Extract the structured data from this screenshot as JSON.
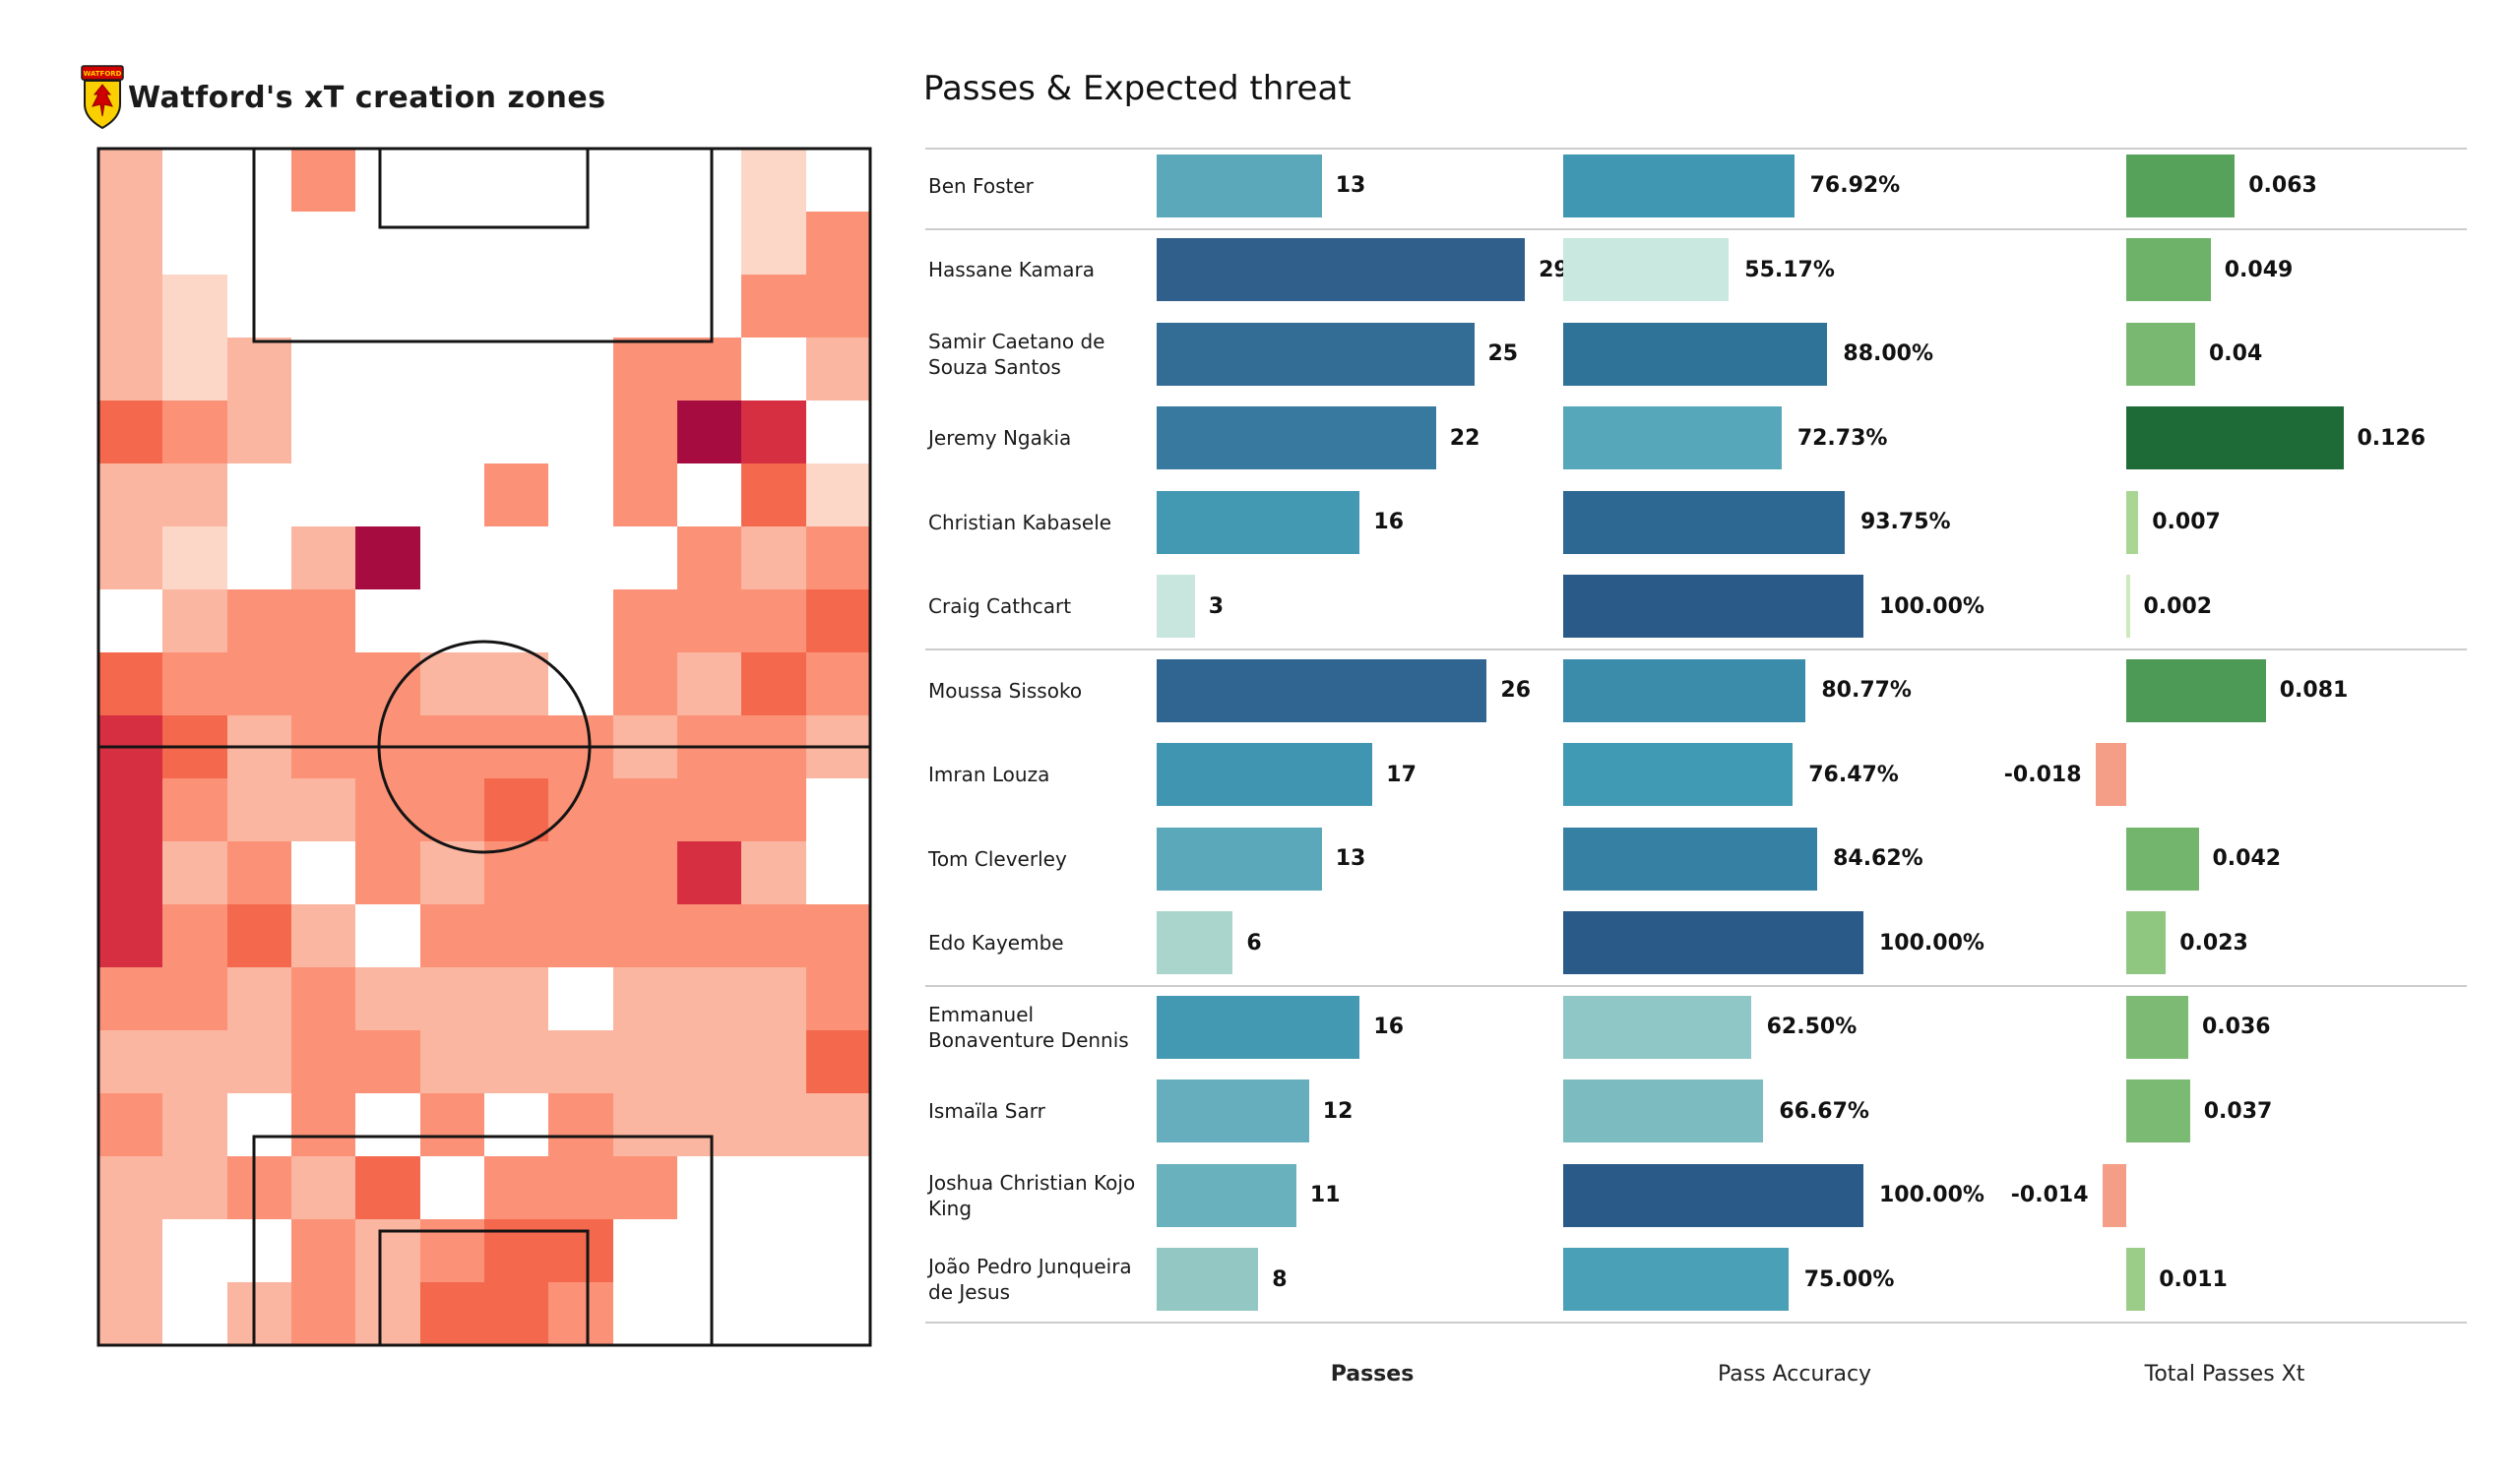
{
  "pitch_panel": {
    "title": "Watford's xT creation zones",
    "club": "Watford",
    "crest_colors": {
      "shield": "#fbd000",
      "band": "#d10000",
      "outline": "#1a1a1a"
    },
    "heatmap_palette": {
      "0": "transparent",
      "1": "#fcd7c8",
      "2": "#fbb6a1",
      "3": "#fb9277",
      "4": "#f4694d",
      "5": "#d62f42",
      "6": "#a60c3f"
    }
  },
  "chart_panel": {
    "title": "Passes & Expected threat",
    "footer": {
      "passes": "Passes",
      "accuracy": "Pass Accuracy",
      "xt": "Total Passes Xt"
    },
    "negative_color": "#f49d87",
    "group_separators_after": [
      0,
      5,
      9,
      13
    ],
    "players": [
      {
        "name": "Ben Foster",
        "passes": 13,
        "accuracy_value": 76.92,
        "accuracy_label": "76.92%",
        "xt": 0.063,
        "xt_label": "0.063",
        "passes_color": "#5ca8bb",
        "accuracy_color": "#4097b2",
        "xt_color": "#57a25b"
      },
      {
        "name": "Hassane Kamara",
        "passes": 29,
        "accuracy_value": 55.17,
        "accuracy_label": "55.17%",
        "xt": 0.049,
        "xt_label": "0.049",
        "passes_color": "#2f5f8a",
        "accuracy_color": "#c9e8e0",
        "xt_color": "#6db268"
      },
      {
        "name": "Samir Caetano de Souza Santos",
        "passes": 25,
        "accuracy_value": 88.0,
        "accuracy_label": "88.00%",
        "xt": 0.04,
        "xt_label": "0.04",
        "passes_color": "#336d96",
        "accuracy_color": "#2f7399",
        "xt_color": "#79b871"
      },
      {
        "name": "Jeremy Ngakia",
        "passes": 22,
        "accuracy_value": 72.73,
        "accuracy_label": "72.73%",
        "xt": 0.126,
        "xt_label": "0.126",
        "passes_color": "#37799f",
        "accuracy_color": "#56a7ba",
        "xt_color": "#1e6b38"
      },
      {
        "name": "Christian Kabasele",
        "passes": 16,
        "accuracy_value": 93.75,
        "accuracy_label": "93.75%",
        "xt": 0.007,
        "xt_label": "0.007",
        "passes_color": "#4398b2",
        "accuracy_color": "#2c6891",
        "xt_color": "#a9d693"
      },
      {
        "name": "Craig Cathcart",
        "passes": 3,
        "accuracy_value": 100.0,
        "accuracy_label": "100.00%",
        "xt": 0.002,
        "xt_label": "0.002",
        "passes_color": "#c8e6de",
        "accuracy_color": "#2a5a88",
        "xt_color": "#cde9bd"
      },
      {
        "name": "Moussa Sissoko",
        "passes": 26,
        "accuracy_value": 80.77,
        "accuracy_label": "80.77%",
        "xt": 0.081,
        "xt_label": "0.081",
        "passes_color": "#2f6590",
        "accuracy_color": "#3b8cab",
        "xt_color": "#4c9a55"
      },
      {
        "name": "Imran Louza",
        "passes": 17,
        "accuracy_value": 76.47,
        "accuracy_label": "76.47%",
        "xt": -0.018,
        "xt_label": "-0.018",
        "passes_color": "#4095b0",
        "accuracy_color": "#419ab4",
        "xt_color": "#f49d87"
      },
      {
        "name": "Tom Cleverley",
        "passes": 13,
        "accuracy_value": 84.62,
        "accuracy_label": "84.62%",
        "xt": 0.042,
        "xt_label": "0.042",
        "passes_color": "#5ca8bb",
        "accuracy_color": "#3681a3",
        "xt_color": "#73b56d"
      },
      {
        "name": "Edo Kayembe",
        "passes": 6,
        "accuracy_value": 100.0,
        "accuracy_label": "100.00%",
        "xt": 0.023,
        "xt_label": "0.023",
        "passes_color": "#a9d5cd",
        "accuracy_color": "#2a5a88",
        "xt_color": "#8fc680"
      },
      {
        "name": "Emmanuel Bonaventure Dennis",
        "passes": 16,
        "accuracy_value": 62.5,
        "accuracy_label": "62.50%",
        "xt": 0.036,
        "xt_label": "0.036",
        "passes_color": "#4398b2",
        "accuracy_color": "#8fc7c6",
        "xt_color": "#7dbb74"
      },
      {
        "name": "Ismaïla Sarr",
        "passes": 12,
        "accuracy_value": 66.67,
        "accuracy_label": "66.67%",
        "xt": 0.037,
        "xt_label": "0.037",
        "passes_color": "#66aebd",
        "accuracy_color": "#7cbcc1",
        "xt_color": "#7bba73"
      },
      {
        "name": "Joshua Christian Kojo King",
        "passes": 11,
        "accuracy_value": 100.0,
        "accuracy_label": "100.00%",
        "xt": -0.014,
        "xt_label": "-0.014",
        "passes_color": "#6ab1be",
        "accuracy_color": "#2a5a88",
        "xt_color": "#f49d87"
      },
      {
        "name": "João Pedro Junqueira de Jesus",
        "passes": 8,
        "accuracy_value": 75.0,
        "accuracy_label": "75.00%",
        "xt": 0.011,
        "xt_label": "0.011",
        "passes_color": "#92c7c3",
        "accuracy_color": "#4aa0b7",
        "xt_color": "#9bcd89"
      }
    ]
  },
  "chart_data": [
    {
      "type": "bar",
      "orientation": "horizontal",
      "title": "Passes",
      "categories": [
        "Ben Foster",
        "Hassane Kamara",
        "Samir Caetano de Souza Santos",
        "Jeremy Ngakia",
        "Christian Kabasele",
        "Craig Cathcart",
        "Moussa Sissoko",
        "Imran Louza",
        "Tom Cleverley",
        "Edo Kayembe",
        "Emmanuel Bonaventure Dennis",
        "Ismaïla Sarr",
        "Joshua Christian Kojo King",
        "João Pedro Junqueira de Jesus"
      ],
      "values": [
        13,
        29,
        25,
        22,
        16,
        3,
        26,
        17,
        13,
        6,
        16,
        12,
        11,
        8
      ],
      "xlim": [
        0,
        29
      ],
      "grid": false,
      "value_labels": true
    },
    {
      "type": "bar",
      "orientation": "horizontal",
      "title": "Pass Accuracy",
      "unit": "%",
      "values": [
        76.92,
        55.17,
        88.0,
        72.73,
        93.75,
        100.0,
        80.77,
        76.47,
        84.62,
        100.0,
        62.5,
        66.67,
        100.0,
        75.0
      ],
      "xlim": [
        0,
        100
      ],
      "grid": false,
      "value_labels": true
    },
    {
      "type": "bar",
      "orientation": "horizontal",
      "title": "Total Passes Xt",
      "values": [
        0.063,
        0.049,
        0.04,
        0.126,
        0.007,
        0.002,
        0.081,
        -0.018,
        0.042,
        0.023,
        0.036,
        0.037,
        -0.014,
        0.011
      ],
      "xlim": [
        -0.02,
        0.126
      ],
      "grid": false,
      "value_labels": true
    },
    {
      "type": "heatmap",
      "title": "Watford's xT creation zones",
      "rows": 19,
      "cols": 12,
      "legend": "intensity levels 0(none)-6(highest xT creation)",
      "grid": [
        [
          2,
          0,
          0,
          3,
          0,
          0,
          0,
          0,
          0,
          0,
          1,
          0
        ],
        [
          2,
          0,
          0,
          0,
          0,
          0,
          0,
          0,
          0,
          0,
          1,
          3
        ],
        [
          2,
          1,
          0,
          0,
          0,
          0,
          0,
          0,
          0,
          0,
          3,
          3
        ],
        [
          2,
          1,
          2,
          0,
          0,
          0,
          0,
          0,
          3,
          3,
          0,
          2
        ],
        [
          4,
          3,
          2,
          0,
          0,
          0,
          0,
          0,
          3,
          6,
          5,
          0
        ],
        [
          2,
          2,
          0,
          0,
          0,
          0,
          3,
          0,
          3,
          0,
          4,
          1
        ],
        [
          2,
          1,
          0,
          2,
          6,
          0,
          0,
          0,
          0,
          3,
          2,
          3
        ],
        [
          0,
          2,
          3,
          3,
          0,
          0,
          0,
          0,
          3,
          3,
          3,
          4
        ],
        [
          4,
          3,
          3,
          3,
          3,
          2,
          2,
          0,
          3,
          2,
          4,
          3
        ],
        [
          5,
          4,
          2,
          3,
          3,
          3,
          3,
          3,
          2,
          3,
          3,
          2
        ],
        [
          5,
          3,
          2,
          2,
          3,
          3,
          4,
          3,
          3,
          3,
          3,
          0
        ],
        [
          5,
          2,
          3,
          0,
          3,
          2,
          3,
          3,
          3,
          5,
          2,
          0
        ],
        [
          5,
          3,
          4,
          2,
          0,
          3,
          3,
          3,
          3,
          3,
          3,
          3
        ],
        [
          3,
          3,
          2,
          3,
          2,
          2,
          2,
          0,
          2,
          2,
          2,
          3
        ],
        [
          2,
          2,
          2,
          3,
          3,
          2,
          2,
          2,
          2,
          2,
          2,
          4
        ],
        [
          3,
          2,
          0,
          3,
          0,
          3,
          0,
          3,
          2,
          2,
          2,
          2
        ],
        [
          2,
          2,
          3,
          2,
          4,
          0,
          3,
          3,
          3,
          0,
          0,
          0
        ],
        [
          2,
          0,
          0,
          3,
          2,
          3,
          4,
          4,
          0,
          0,
          0,
          0
        ],
        [
          2,
          0,
          2,
          3,
          2,
          4,
          4,
          3,
          0,
          0,
          0,
          0
        ]
      ]
    }
  ]
}
